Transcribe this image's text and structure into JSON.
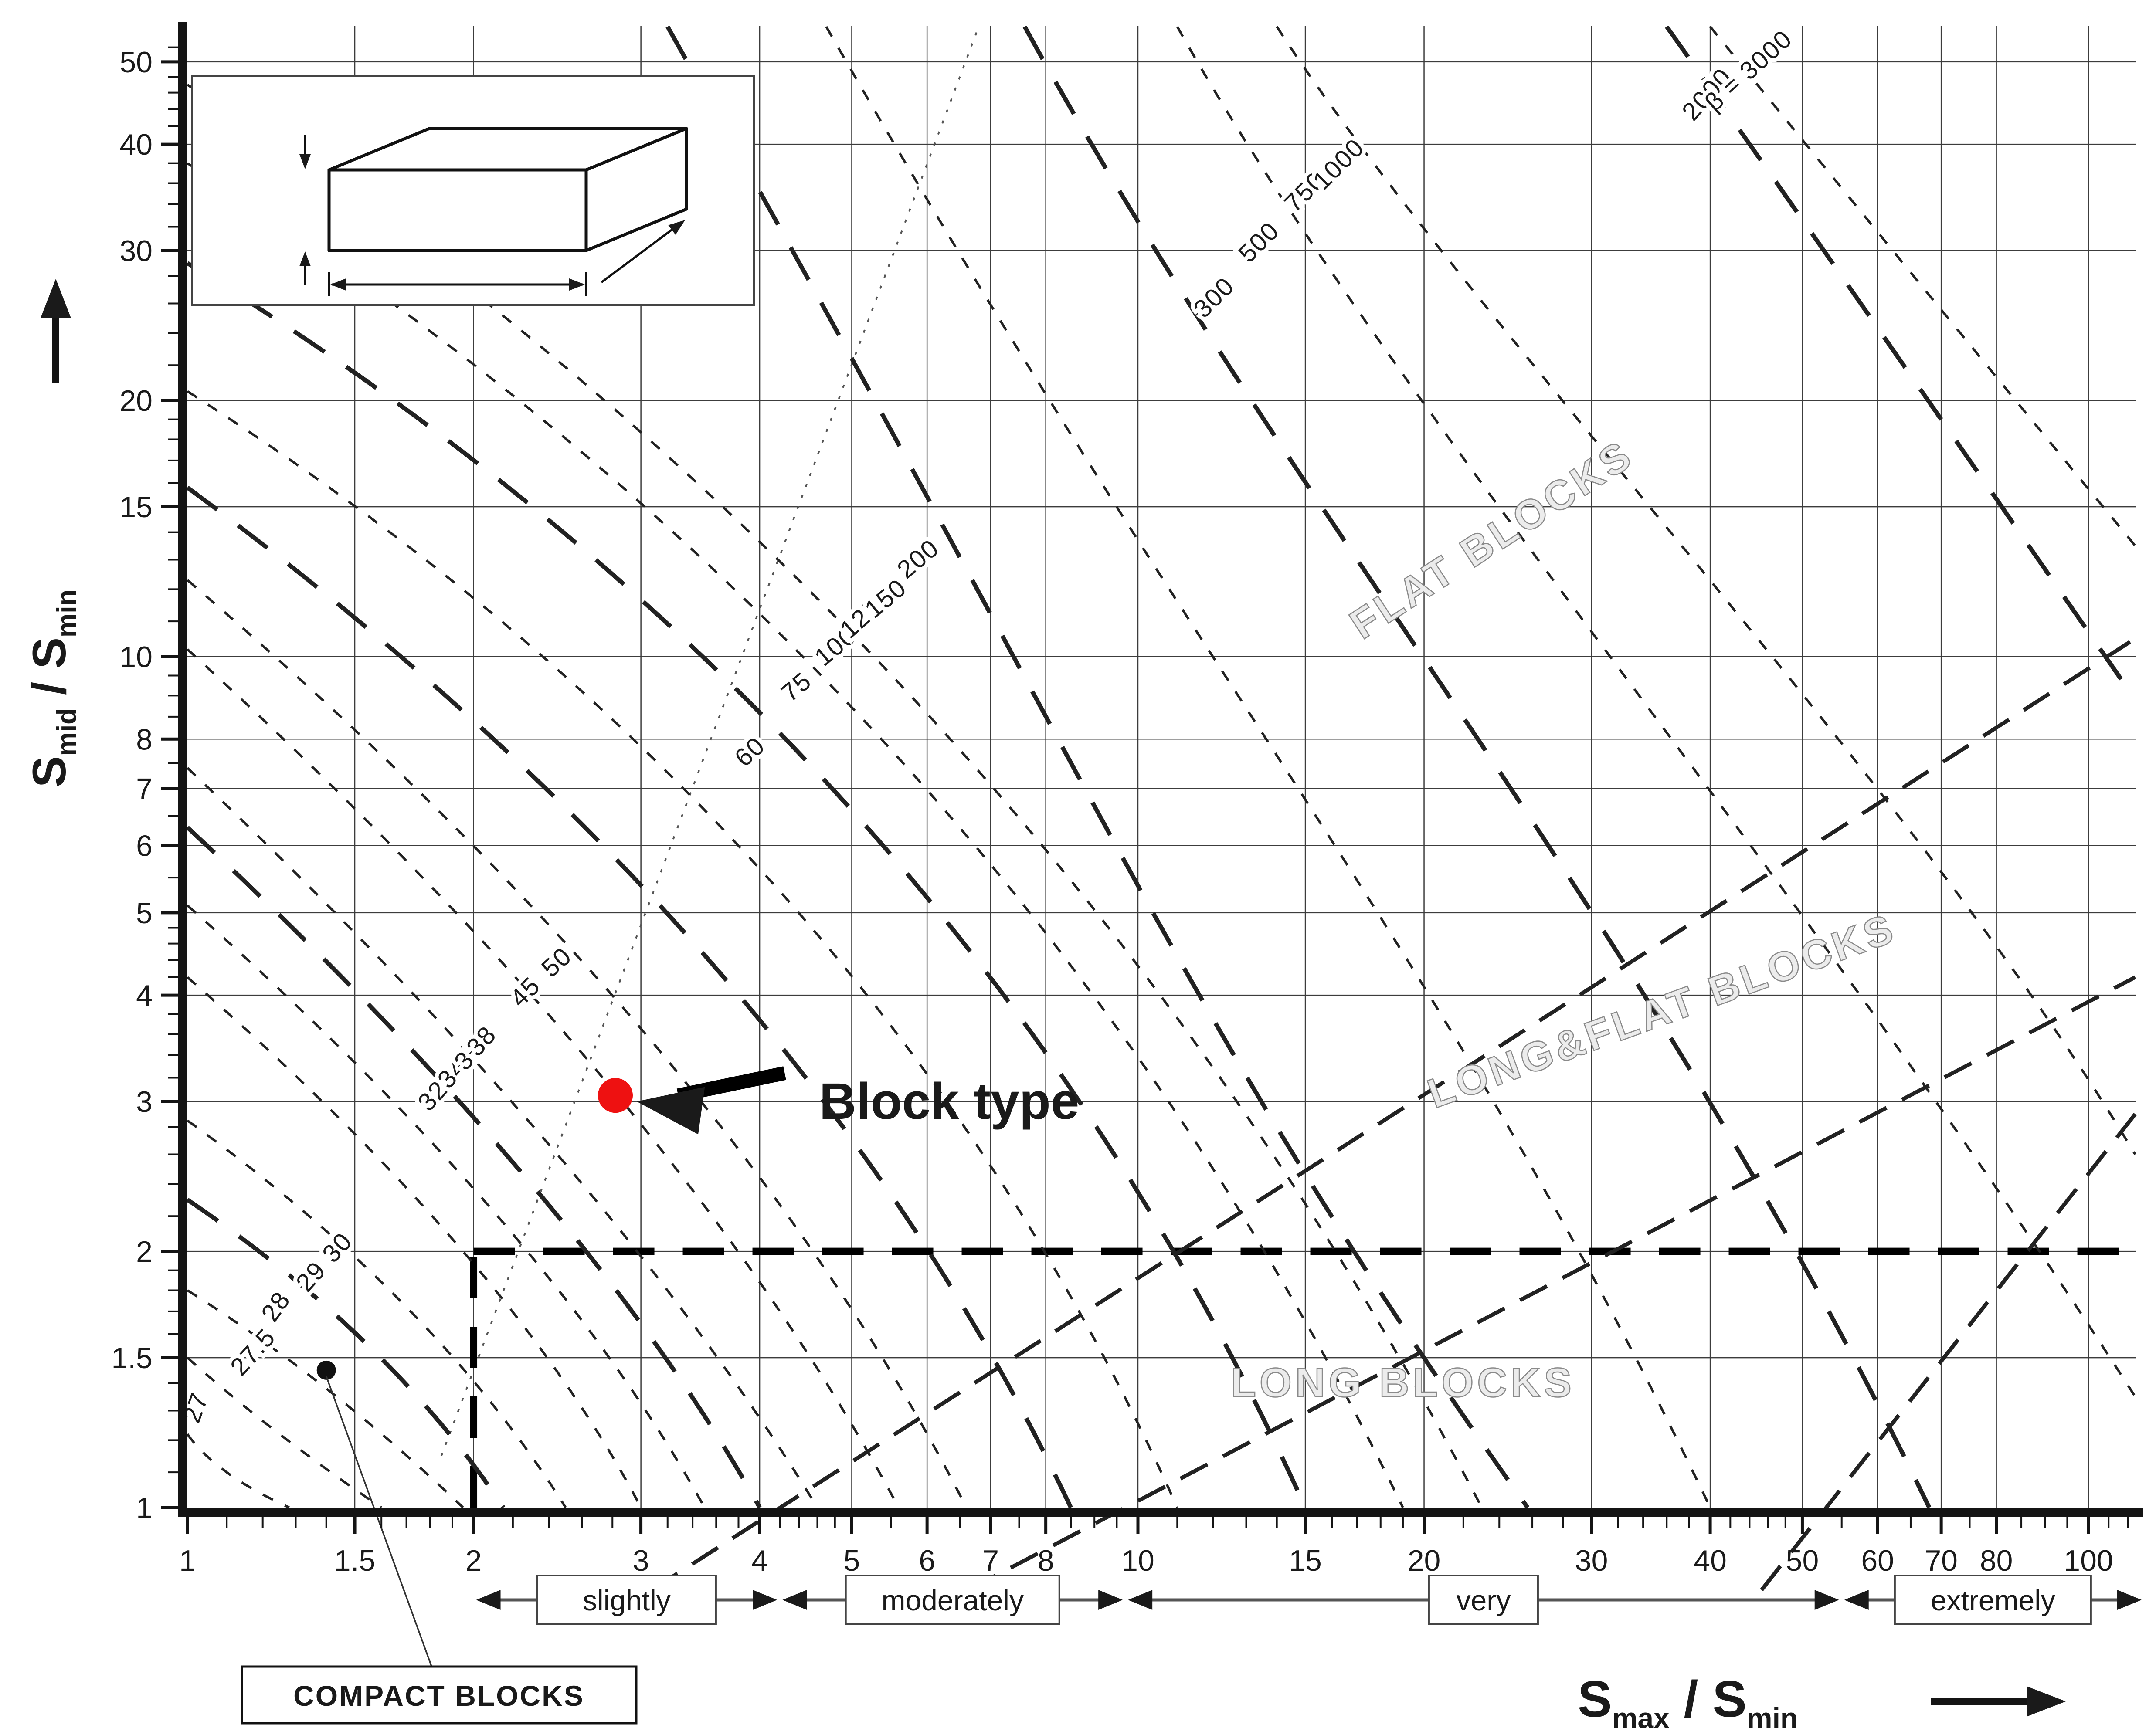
{
  "chart_data": {
    "type": "contour",
    "title": "Block types characterized by block shape factor beta",
    "xlabel": "Smax / Smin",
    "ylabel": "Smid / Smin",
    "x_scale": "log",
    "y_scale": "log",
    "xlim": [
      1,
      112
    ],
    "ylim": [
      1,
      55
    ],
    "grid": true,
    "axis_titles": {
      "x": {
        "s1": "S",
        "sub1": "max",
        "sep": " / ",
        "s2": "S",
        "sub2": "min"
      },
      "y": {
        "s1": "S",
        "sub1": "mid",
        "sep": " / ",
        "s2": "S",
        "sub2": "min"
      }
    },
    "x_ticks": [
      {
        "v": 1,
        "t": "1"
      },
      {
        "v": 1.5,
        "t": "1.5"
      },
      {
        "v": 2,
        "t": "2"
      },
      {
        "v": 3,
        "t": "3"
      },
      {
        "v": 4,
        "t": "4"
      },
      {
        "v": 5,
        "t": "5"
      },
      {
        "v": 6,
        "t": "6"
      },
      {
        "v": 7,
        "t": "7"
      },
      {
        "v": 8,
        "t": "8"
      },
      {
        "v": 10,
        "t": "10"
      },
      {
        "v": 15,
        "t": "15"
      },
      {
        "v": 20,
        "t": "20"
      },
      {
        "v": 30,
        "t": "30"
      },
      {
        "v": 40,
        "t": "40"
      },
      {
        "v": 50,
        "t": "50"
      },
      {
        "v": 60,
        "t": "60"
      },
      {
        "v": 70,
        "t": "70"
      },
      {
        "v": 80,
        "t": "80"
      },
      {
        "v": 100,
        "t": "100"
      }
    ],
    "y_ticks": [
      {
        "v": 1,
        "t": "1"
      },
      {
        "v": 1.5,
        "t": "1.5"
      },
      {
        "v": 2,
        "t": "2"
      },
      {
        "v": 3,
        "t": "3"
      },
      {
        "v": 4,
        "t": "4"
      },
      {
        "v": 5,
        "t": "5"
      },
      {
        "v": 6,
        "t": "6"
      },
      {
        "v": 7,
        "t": "7"
      },
      {
        "v": 8,
        "t": "8"
      },
      {
        "v": 10,
        "t": "10"
      },
      {
        "v": 15,
        "t": "15"
      },
      {
        "v": 20,
        "t": "20"
      },
      {
        "v": 30,
        "t": "30"
      },
      {
        "v": 40,
        "t": "40"
      },
      {
        "v": 50,
        "t": "50"
      }
    ],
    "x_minor_ticks": [
      1.1,
      1.2,
      1.3,
      1.4,
      1.6,
      1.7,
      1.8,
      1.9,
      2.2,
      2.4,
      2.6,
      2.8,
      3.2,
      3.4,
      3.6,
      3.8,
      4.2,
      4.4,
      4.6,
      4.8,
      5.5,
      6.5,
      7.5,
      8.5,
      9,
      9.5,
      11,
      12,
      13,
      14,
      16,
      17,
      18,
      19,
      22,
      24,
      26,
      28,
      32,
      34,
      36,
      38,
      42,
      44,
      46,
      48,
      55,
      65,
      75,
      85,
      90,
      95,
      105,
      110
    ],
    "y_minor_ticks": [
      1.1,
      1.2,
      1.3,
      1.4,
      1.6,
      1.7,
      1.8,
      1.9,
      2.2,
      2.4,
      2.6,
      2.8,
      3.2,
      3.4,
      3.6,
      3.8,
      4.2,
      4.4,
      4.6,
      4.8,
      5.5,
      6.5,
      7.5,
      8.5,
      9,
      9.5,
      11,
      12,
      13,
      14,
      16,
      17,
      18,
      19,
      22,
      24,
      26,
      28,
      32,
      34,
      36,
      38,
      42,
      44,
      46,
      48,
      52
    ],
    "contours": [
      {
        "label": "27",
        "A": [
          1,
          1.22
        ],
        "K": [
          1.1,
          1.1
        ],
        "B": [
          1.28,
          1
        ],
        "lab": [
          1.04,
          1.3
        ],
        "rot": -70,
        "bold": false
      },
      {
        "label": "27.5",
        "A": [
          1,
          1.5
        ],
        "K": [
          1.25,
          1.22
        ],
        "B": [
          1.6,
          1
        ],
        "lab": [
          1.19,
          1.5
        ],
        "rot": -48,
        "bold": false
      },
      {
        "label": "28",
        "A": [
          1,
          1.8
        ],
        "K": [
          1.4,
          1.38
        ],
        "B": [
          1.95,
          1
        ],
        "lab": [
          1.26,
          1.7
        ],
        "rot": -55,
        "bold": false
      },
      {
        "label": "29",
        "A": [
          1,
          2.3
        ],
        "K": [
          1.55,
          1.55
        ],
        "B": [
          2.15,
          1
        ],
        "lab": [
          1.37,
          1.84
        ],
        "rot": -48,
        "bold": true
      },
      {
        "label": "30",
        "A": [
          1,
          2.85
        ],
        "K": [
          1.7,
          1.72
        ],
        "B": [
          2.5,
          1
        ],
        "lab": [
          1.46,
          1.99
        ],
        "rot": -48,
        "bold": false
      },
      {
        "label": "32",
        "A": [
          1,
          4.2
        ],
        "K": [
          1.95,
          2.0
        ],
        "B": [
          3.0,
          1
        ],
        "lab": [
          1.84,
          3.0
        ],
        "rot": -48,
        "bold": false
      },
      {
        "label": "34",
        "A": [
          1,
          5.1
        ],
        "K": [
          2.12,
          2.2
        ],
        "B": [
          3.5,
          1
        ],
        "lab": [
          1.93,
          3.19
        ],
        "rot": -48,
        "bold": false
      },
      {
        "label": "36",
        "A": [
          1,
          6.3
        ],
        "K": [
          2.3,
          2.4
        ],
        "B": [
          4.0,
          1
        ],
        "lab": [
          2.01,
          3.35
        ],
        "rot": -48,
        "bold": true
      },
      {
        "label": "38",
        "A": [
          1,
          7.4
        ],
        "K": [
          2.45,
          2.6
        ],
        "B": [
          4.6,
          1
        ],
        "lab": [
          2.07,
          3.48
        ],
        "rot": -48,
        "bold": false
      },
      {
        "label": "45",
        "A": [
          1,
          10.2
        ],
        "K": [
          2.8,
          3.1
        ],
        "B": [
          5.6,
          1
        ],
        "lab": [
          2.3,
          3.97
        ],
        "rot": -45,
        "bold": false
      },
      {
        "label": "50",
        "A": [
          1,
          12.3
        ],
        "K": [
          3.1,
          3.5
        ],
        "B": [
          6.6,
          1
        ],
        "lab": [
          2.48,
          4.3
        ],
        "rot": -42,
        "bold": false
      },
      {
        "label": "60",
        "A": [
          1,
          15.8
        ],
        "K": [
          3.6,
          4.3
        ],
        "B": [
          8.5,
          1
        ],
        "lab": [
          3.96,
          7.6
        ],
        "rot": -42,
        "bold": true
      },
      {
        "label": "75",
        "A": [
          1,
          20.5
        ],
        "K": [
          4.2,
          5.3
        ],
        "B": [
          11,
          1
        ],
        "lab": [
          4.43,
          9.05
        ],
        "rot": -40,
        "bold": false
      },
      {
        "label": "100",
        "A": [
          1,
          29
        ],
        "K": [
          5.0,
          6.6
        ],
        "B": [
          15,
          1
        ],
        "lab": [
          4.87,
          10.1
        ],
        "rot": -40,
        "bold": true
      },
      {
        "label": "125",
        "A": [
          1,
          38
        ],
        "K": [
          5.6,
          7.6
        ],
        "B": [
          19,
          1
        ],
        "lab": [
          5.18,
          10.9
        ],
        "rot": -42,
        "bold": false
      },
      {
        "label": "150",
        "A": [
          1,
          47
        ],
        "K": [
          6.1,
          8.4
        ],
        "B": [
          23,
          1
        ],
        "lab": [
          5.5,
          11.5
        ],
        "rot": -40,
        "bold": false
      },
      {
        "label": "200",
        "A": [
          3.2,
          55
        ],
        "K": [
          7.2,
          11
        ],
        "K2": [
          14,
          2.6
        ],
        "B": [
          25.7,
          1
        ],
        "lab": [
          5.95,
          12.8
        ],
        "rot": -40,
        "bold": true
      },
      {
        "label": "300",
        "A": [
          4.7,
          55
        ],
        "K": [
          9.3,
          14.5
        ],
        "K2": [
          25,
          3
        ],
        "B": [
          40,
          1
        ],
        "lab": [
          12.2,
          26
        ],
        "rot": -45,
        "bold": false
      },
      {
        "label": "500",
        "A": [
          7.6,
          55
        ],
        "K": [
          12.5,
          20
        ],
        "K2": [
          40,
          3.4
        ],
        "B": [
          68,
          1
        ],
        "lab": [
          13.6,
          30.2
        ],
        "rot": -45,
        "bold": true
      },
      {
        "label": "750",
        "A": [
          11,
          55
        ],
        "K": [
          16,
          26
        ],
        "K2": [
          60,
          4
        ],
        "B": [
          112,
          1.35
        ],
        "lab": [
          15.2,
          34.6
        ],
        "rot": -45,
        "bold": false
      },
      {
        "label": "1000",
        "A": [
          14,
          55
        ],
        "K": [
          19.5,
          31
        ],
        "K2": [
          75,
          5.5
        ],
        "B": [
          112,
          2.6
        ],
        "lab": [
          16.5,
          37.3
        ],
        "rot": -45,
        "bold": false
      },
      {
        "label": "2000",
        "A": [
          36,
          55
        ],
        "K": [
          55,
          28
        ],
        "B": [
          112,
          8.9
        ],
        "lab": [
          40.3,
          45.1
        ],
        "rot": -48,
        "bold": true
      },
      {
        "label": "β = 3000",
        "A": [
          40,
          55
        ],
        "K": [
          66,
          27.7
        ],
        "B": [
          112,
          13.5
        ],
        "lab": [
          44.5,
          48.0
        ],
        "rot": -42,
        "bold": false
      }
    ],
    "thresholds": {
      "horizontal": {
        "y": 2,
        "x1": 2,
        "x2": 112
      },
      "vertical": {
        "x": 2,
        "y1": 1,
        "y2": 2
      }
    },
    "separators": [
      {
        "name": "flat-longflat-separator",
        "pts": [
          [
            3.08,
            0.8
          ],
          [
            112,
            10.5
          ]
        ]
      },
      {
        "name": "longflat-long-separator",
        "pts": [
          [
            6.63,
            0.8
          ],
          [
            112,
            4.2
          ]
        ]
      },
      {
        "name": "very-extremely-separator",
        "pts": [
          [
            45.3,
            0.8
          ],
          [
            112,
            2.9
          ]
        ]
      }
    ],
    "dotted_line": {
      "pts": [
        [
          1.85,
          1.15
        ],
        [
          6.8,
          55
        ]
      ]
    },
    "regions": [
      {
        "text": "FLAT BLOCKS",
        "x": 24,
        "y": 13.3,
        "rot": -33
      },
      {
        "text": "LONG&FLAT BLOCKS",
        "x": 36,
        "y": 3.7,
        "rot": -20
      },
      {
        "text": "LONG BLOCKS",
        "x": 19,
        "y": 1.35,
        "rot": 0
      }
    ],
    "points": [
      {
        "name": "compact-blocks-point",
        "x": 1.4,
        "y": 1.45,
        "r": 22,
        "color": "#111111"
      },
      {
        "name": "block-type-point",
        "x": 2.82,
        "y": 3.05,
        "r": 40,
        "color": "#ee1111"
      }
    ],
    "annotations": {
      "block_type": {
        "text": "Block type",
        "text_x": 4.62,
        "text_y": 3.0,
        "tip_x": 2.97,
        "tip_y": 3.0
      },
      "compact_blocks": {
        "text": "COMPACT BLOCKS"
      }
    },
    "scale_bands": [
      {
        "label": "slightly",
        "from": 2,
        "to": 4.2
      },
      {
        "label": "moderately",
        "from": 4.2,
        "to": 9.7
      },
      {
        "label": "very",
        "from": 9.7,
        "to": 55
      },
      {
        "label": "extremely",
        "from": 55,
        "to": 116
      }
    ]
  },
  "inset": {
    "s_min": {
      "s": "S",
      "sub": "min"
    },
    "s_max": {
      "s": "S",
      "sub": "max"
    },
    "s_mid": {
      "s": "S",
      "sub": "mid"
    }
  },
  "colors": {
    "ink": "#1a1a1a",
    "grid": "#3c3c3c",
    "contour": "#222222",
    "region_outline": "#8a8a8a",
    "region_fill": "#ececec",
    "accent_red": "#ee1111",
    "background": "#ffffff"
  }
}
